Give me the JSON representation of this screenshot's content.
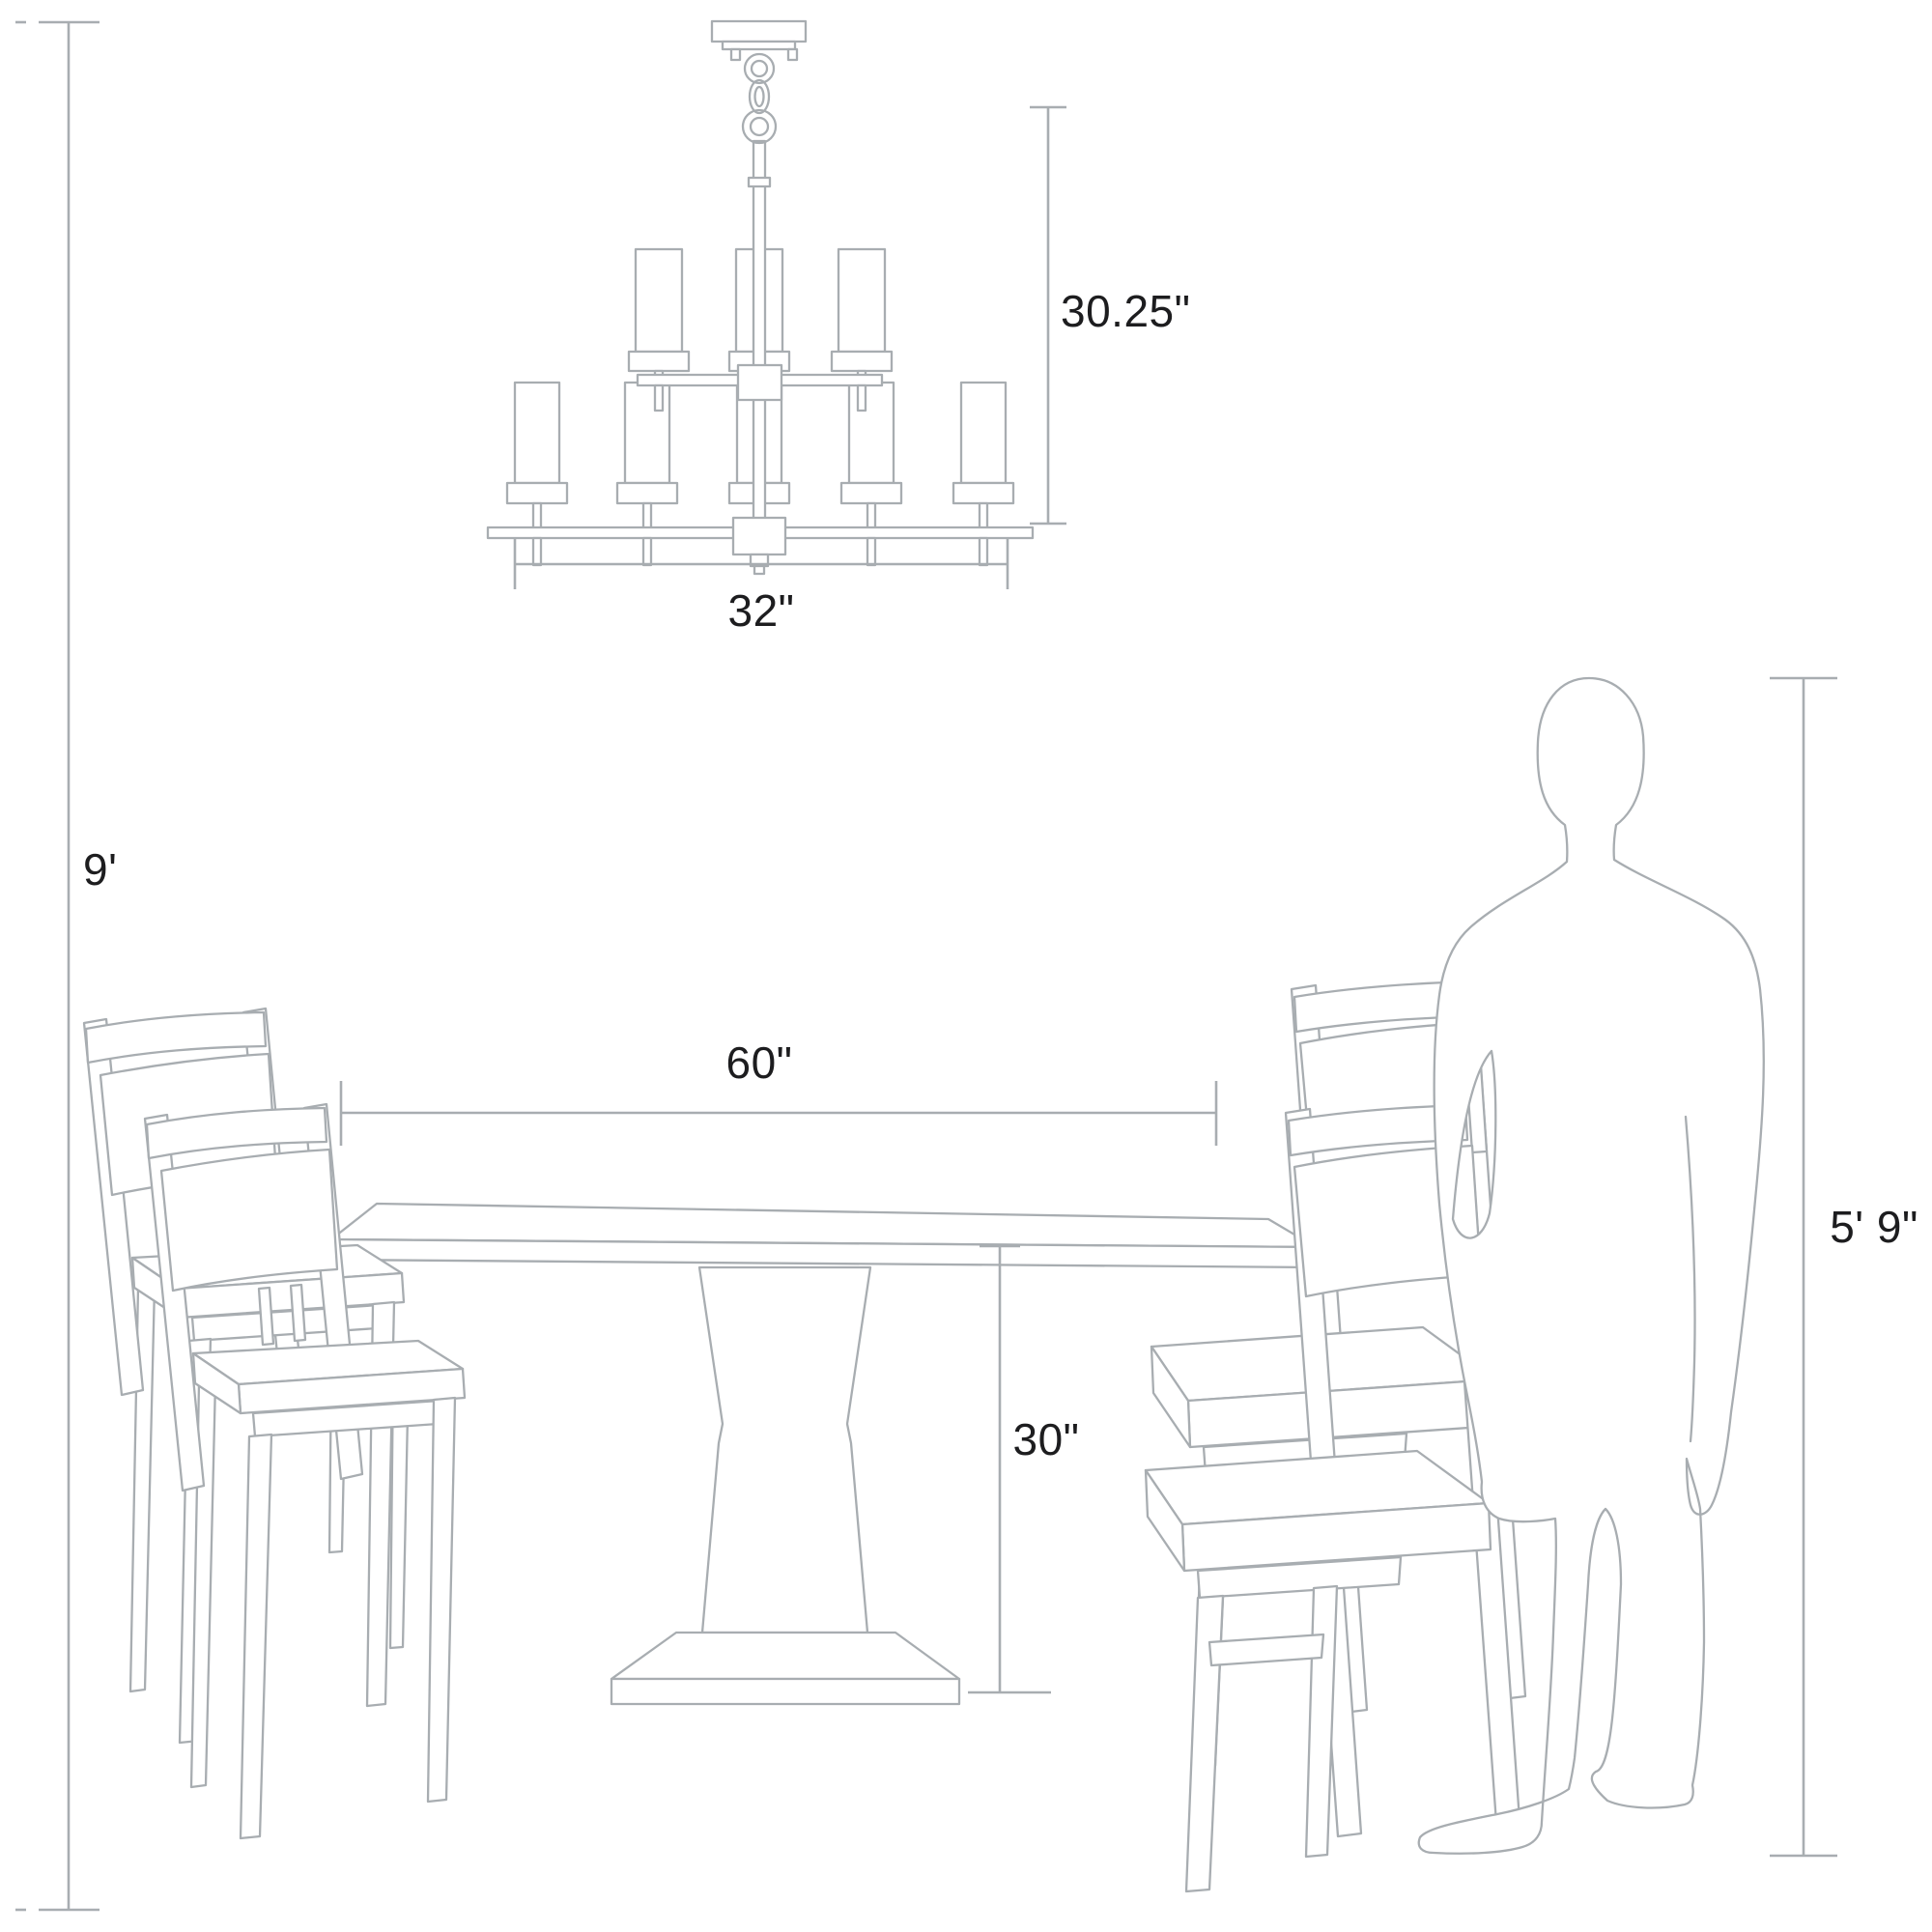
{
  "diagram": {
    "type": "product-dimension-diagram",
    "scene": "dining room scale drawing with chandelier, pedestal dining table, four chairs and human figure for scale"
  },
  "style": {
    "line_color": "#a8adb1",
    "text_color": "#1d1d1f",
    "background": "#ffffff"
  },
  "dimensions": {
    "room_height": {
      "label": "9'"
    },
    "chandelier_height": {
      "label": "30.25\""
    },
    "chandelier_width": {
      "label": "32\""
    },
    "table_width": {
      "label": "60\""
    },
    "table_height": {
      "label": "30\""
    },
    "person_height": {
      "label": "5' 9\""
    }
  },
  "objects": {
    "chandelier": "two-tier nine light chandelier with cylinder shades",
    "table": "rectangular pedestal dining table",
    "chairs": "four ladder style side chairs",
    "person": "standing human silhouette"
  }
}
